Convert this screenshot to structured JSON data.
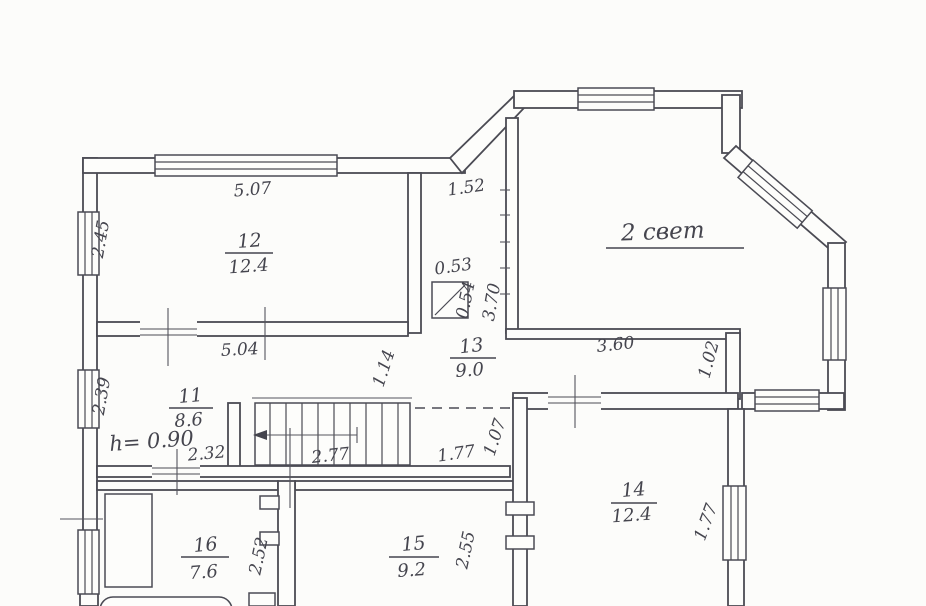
{
  "plan": {
    "background": "#fcfcfa",
    "ink": "#45454e",
    "rooms": {
      "r11": {
        "number": "11",
        "area": "8.6"
      },
      "r12": {
        "number": "12",
        "area": "12.4"
      },
      "r13": {
        "number": "13",
        "area": "9.0"
      },
      "r14": {
        "number": "14",
        "area": "12.4"
      },
      "r15": {
        "number": "15",
        "area": "9.2"
      },
      "r16": {
        "number": "16",
        "area": "7.6"
      }
    },
    "annotations": {
      "second_light": "2 свет",
      "ceiling_height": "h= 0.90"
    },
    "dimensions": {
      "room12_top": "5.07",
      "nook_width": "1.52",
      "room12_left": "2.45",
      "flue_width": "0.53",
      "flue_depth": "0.54",
      "partition_height": "3.70",
      "hall_width": "5.04",
      "bay_bottom": "3.60",
      "bay_return": "1.02",
      "corridor_width": "1.14",
      "hall_left": "2.39",
      "under_stairs": "2.32",
      "stairs_run": "2.77",
      "landing_length": "1.77",
      "landing_width": "1.07",
      "room16_depth": "2.52",
      "room15_depth": "2.55",
      "room14_window": "1.77"
    }
  }
}
